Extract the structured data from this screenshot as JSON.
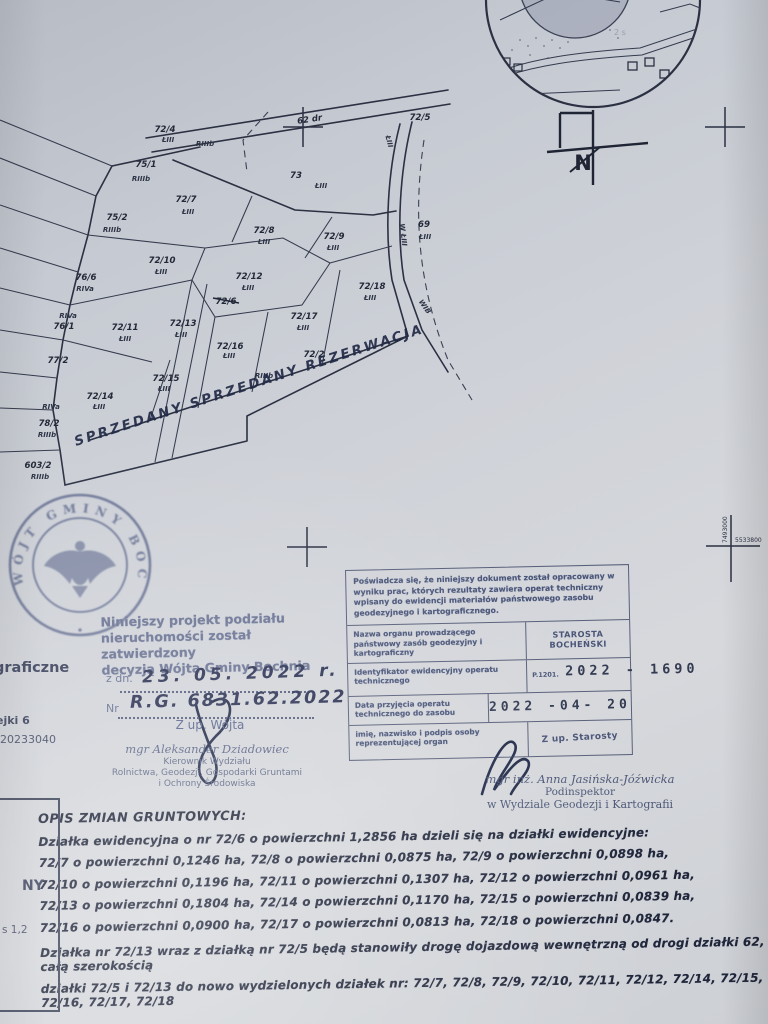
{
  "map": {
    "labels": [
      "62 dr",
      "72/5",
      "72/4",
      "ŁIII",
      "RIIIb",
      "75/1",
      "RIIIb",
      "73",
      "ŁIII",
      "72/7",
      "ŁIII",
      "75/2",
      "RIIIb",
      "72/8",
      "ŁIII",
      "72/9",
      "ŁIII",
      "69",
      "ŁIII",
      "72/10",
      "ŁIII",
      "76/6",
      "RIVa",
      "72/12",
      "ŁIII",
      "72/6",
      "72/18",
      "ŁIII",
      "RIVa",
      "76/1",
      "72/11",
      "ŁIII",
      "72/13",
      "ŁIII",
      "72/17",
      "ŁIII",
      "77/2",
      "72/16",
      "ŁIII",
      "72/2",
      "RIIIb",
      "72/15",
      "ŁIII",
      "72/14",
      "ŁIII",
      "RIVa",
      "78/2",
      "RIIIb",
      "603/2",
      "RIIIb",
      "W ŁIII",
      "WIB",
      "ŁIII"
    ],
    "handwriting": "SPRZEDANY SPRZEDANY REZERWACJA"
  },
  "inset": {
    "faint_label": "2 s"
  },
  "north": {
    "label": "N"
  },
  "coords": {
    "vertical": "7493000",
    "horizontal": "5533800"
  },
  "seal": {
    "text": "WÓJT GMINY BOCHNIA"
  },
  "approval": {
    "line1": "Niniejszy projekt podziału",
    "line2": "nieruchomości został zatwierdzony",
    "line3": "decyzją Wójta Gminy Bochnia",
    "date_prefix": "z dn.",
    "date_value": "23. 05. 2022 r.",
    "nr_prefix": "Nr",
    "nr_value": "R.G. 6831.62.2022",
    "by": "Z up. Wójta",
    "name": "mgr Aleksander Dziadowiec",
    "role1": "Kierownik Wydziału",
    "role2": "Rolnictwa, Geodezji, Gospodarki Gruntami",
    "role3": "i Ochrony Środowiska"
  },
  "fragments": {
    "left1": "graficzne",
    "left2": "ejki 6",
    "left3": "120233040",
    "box1": "NY",
    "box2": "s 1,2"
  },
  "certificate": {
    "statement": "Poświadcza się, że niniejszy dokument został opracowany w wyniku prac, których rezultaty zawiera operat techniczny wpisany do ewidencji materiałów państwowego zasobu geodezyjnego i kartograficznego.",
    "rows": [
      {
        "label": "Nazwa organu prowadzącego państwowy zasób geodezyjny i kartograficzny",
        "value": "STAROSTA BOCHEŃSKI"
      },
      {
        "label": "Identyfikator ewidencyjny operatu technicznego",
        "value_prefix": "P.1201.",
        "value": "2022 - 1690"
      },
      {
        "label": "Data przyjęcia operatu technicznego do zasobu",
        "value": "2022 -04- 20"
      },
      {
        "label": "imię, nazwisko i podpis osoby reprezentującej organ",
        "value": "Z up. Starosty"
      }
    ],
    "signer_name": "mgr inż. Anna Jasińska-Jóźwicka",
    "signer_role": "Podinspektor",
    "signer_dept": "w Wydziale Geodezji i Kartografii"
  },
  "opis": {
    "title": "OPIS ZMIAN GRUNTOWYCH:",
    "para1": [
      "Działka ewidencyjna o nr 72/6 o powierzchni 1,2856 ha dzieli się na działki ewidencyjne:",
      "72/7 o powierzchni 0,1246 ha, 72/8 o powierzchni 0,0875 ha, 72/9 o powierzchni 0,0898 ha,",
      "72/10 o powierzchni 0,1196 ha, 72/11 o powierzchni 0,1307 ha, 72/12 o powierzchni 0,0961 ha,",
      "72/13 o powierzchni 0,1804 ha, 72/14 o powierzchni 0,1170 ha, 72/15 o powierzchni 0,0839 ha,",
      "72/16 o powierzchni 0,0900 ha, 72/17 o powierzchni 0,0813 ha, 72/18 o powierzchni 0,0847."
    ],
    "para2": [
      "Działka nr 72/13 wraz z działką nr 72/5 będą stanowiły drogę dojazdową wewnętrzną od drogi działki 62, całą szerokością",
      "działki 72/5 i 72/13 do nowo wydzielonych działek nr: 72/7, 72/8, 72/9, 72/10, 72/11, 72/12, 72/14, 72/15, 72/16, 72/17, 72/18"
    ]
  }
}
